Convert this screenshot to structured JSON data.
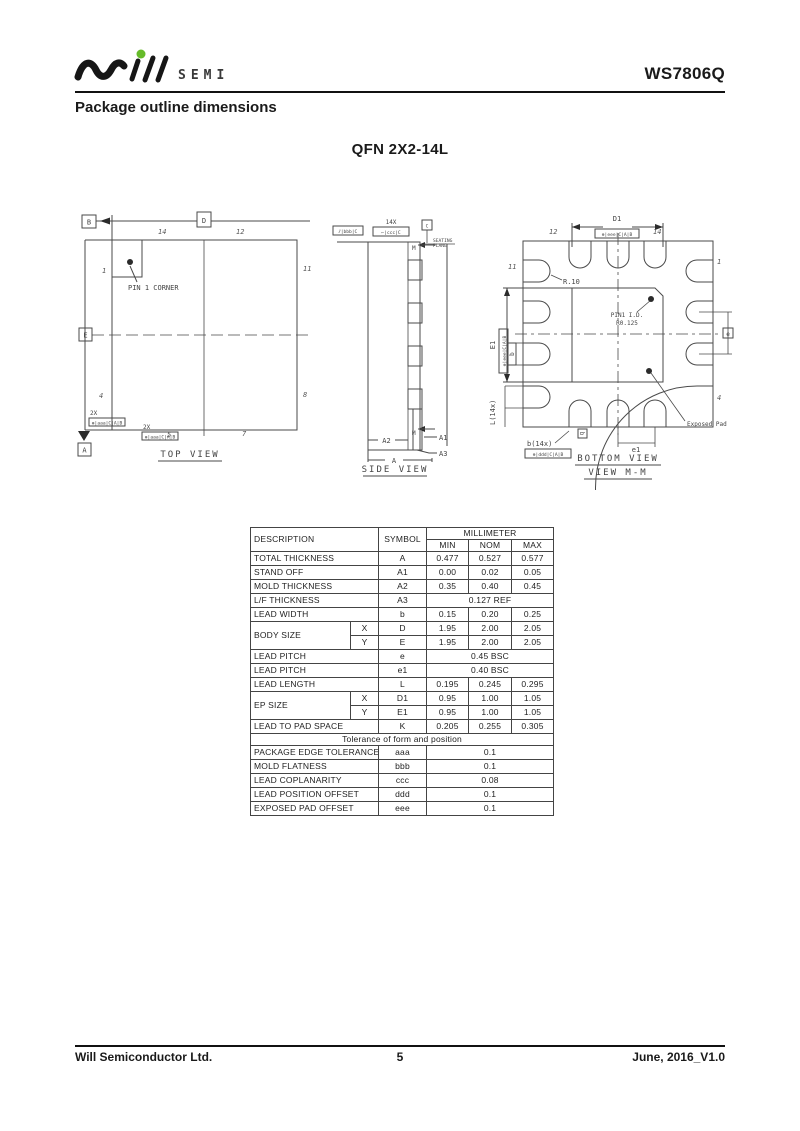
{
  "header": {
    "brand": "SEMI",
    "part": "WS7806Q",
    "section": "Package outline dimensions"
  },
  "drawing_title": "QFN 2X2-14L",
  "top_view": {
    "title": "TOP VIEW",
    "pin1_label": "PIN 1 CORNER",
    "pin_tl": "14",
    "pin_tr": "12",
    "pin_lt": "1",
    "pin_rt": "11",
    "pin_lb": "4",
    "pin_rb": "8",
    "pin_bl": "5",
    "pin_br": "7",
    "datum_b": "B",
    "datum_d": "D",
    "datum_e": "E",
    "datum_a": "A",
    "qty1": "2X",
    "frame1": "⊕|aaa|C|A|B",
    "qty2": "2X",
    "frame2": "⊕|aaa|C|A|B"
  },
  "side_view": {
    "title": "SIDE VIEW",
    "frame_parallel": "⫽|bbb|C",
    "qty": "14X",
    "frame_coplanarity": "⌐|ccc|C",
    "datum_c": "C",
    "seating_line1": "SEATING",
    "seating_line2": "PLANE",
    "m_top": "M",
    "m_bottom": "M",
    "dim_a2": "A2",
    "dim_a1": "A1",
    "dim_a3": "A3",
    "dim_a": "A"
  },
  "bottom_view": {
    "title": "BOTTOM VIEW",
    "subtitle": "VIEW M-M",
    "dim_d1": "D1",
    "frame_d1": "⊕|eee|C|A|B",
    "dim_e1": "E1",
    "frame_e1": "⊕|eee|C|A|B",
    "dim_b": "b(14x)",
    "frame_b": "⊕|ddd|C|A|B",
    "dim_l": "L(14x)",
    "b_label": "b",
    "b_label2": "b",
    "dim_e": "e",
    "dim_e1_pitch": "e1",
    "radius_label": "R.10",
    "pin1_id_line1": "PIN1 I.D.",
    "pin1_id_line2": "R0.125",
    "exposed_pad_label": "Exposed Pad",
    "pin_tl": "12",
    "pin_tr": "14",
    "pin_lt": "11",
    "pin_rt": "1",
    "pin_rb": "4"
  },
  "table": {
    "col_description": "DESCRIPTION",
    "col_symbol": "SYMBOL",
    "col_unit": "MILLIMETER",
    "col_min": "MIN",
    "col_nom": "NOM",
    "col_max": "MAX",
    "rows": [
      {
        "desc": "TOTAL THICKNESS",
        "sym": "A",
        "min": "0.477",
        "nom": "0.527",
        "max": "0.577"
      },
      {
        "desc": "STAND OFF",
        "sym": "A1",
        "min": "0.00",
        "nom": "0.02",
        "max": "0.05"
      },
      {
        "desc": "MOLD THICKNESS",
        "sym": "A2",
        "min": "0.35",
        "nom": "0.40",
        "max": "0.45"
      },
      {
        "desc": "L/F THICKNESS",
        "sym": "A3",
        "span": "0.127  REF"
      },
      {
        "desc": "LEAD WIDTH",
        "sym": "b",
        "min": "0.15",
        "nom": "0.20",
        "max": "0.25"
      }
    ],
    "body_size": {
      "desc": "BODY SIZE",
      "x_label": "X",
      "y_label": "Y",
      "x_sym": "D",
      "x_min": "1.95",
      "x_nom": "2.00",
      "x_max": "2.05",
      "y_sym": "E",
      "y_min": "1.95",
      "y_nom": "2.00",
      "y_max": "2.05"
    },
    "rows2": [
      {
        "desc": "LEAD PITCH",
        "sym": "e",
        "span": "0.45  BSC"
      },
      {
        "desc": "LEAD PITCH",
        "sym": "e1",
        "span": "0.40  BSC"
      },
      {
        "desc": "LEAD LENGTH",
        "sym": "L",
        "min": "0.195",
        "nom": "0.245",
        "max": "0.295"
      }
    ],
    "ep_size": {
      "desc": "EP SIZE",
      "x_label": "X",
      "y_label": "Y",
      "x_sym": "D1",
      "x_min": "0.95",
      "x_nom": "1.00",
      "x_max": "1.05",
      "y_sym": "E1",
      "y_min": "0.95",
      "y_nom": "1.00",
      "y_max": "1.05"
    },
    "row_k": {
      "desc": "LEAD TO PAD SPACE",
      "sym": "K",
      "min": "0.205",
      "nom": "0.255",
      "max": "0.305"
    },
    "tolerance_title": "Tolerance  of  form  and  position",
    "tol_rows": [
      {
        "desc": "PACKAGE EDGE TOLERANCE",
        "sym": "aaa",
        "val": "0.1"
      },
      {
        "desc": "MOLD FLATNESS",
        "sym": "bbb",
        "val": "0.1"
      },
      {
        "desc": "LEAD COPLANARITY",
        "sym": "ccc",
        "val": "0.08"
      },
      {
        "desc": "LEAD POSITION OFFSET",
        "sym": "ddd",
        "val": "0.1"
      },
      {
        "desc": "EXPOSED PAD OFFSET",
        "sym": "eee",
        "val": "0.1"
      }
    ]
  },
  "footer": {
    "company": "Will Semiconductor Ltd.",
    "page": "5",
    "version": "June, 2016_V1.0"
  }
}
